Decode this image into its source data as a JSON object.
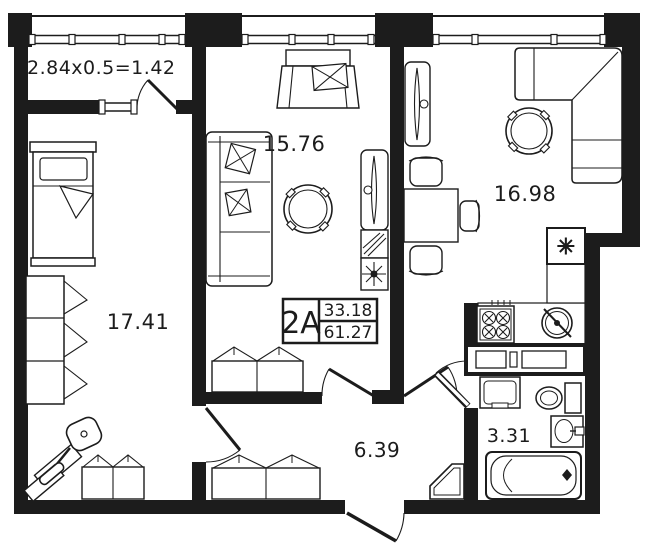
{
  "plan": {
    "unit_title": "2A",
    "living_area": "33.18",
    "total_area": "61.27",
    "balcony_formula": "2.84x0.5=1.42",
    "rooms": {
      "bedroom": "17.41",
      "living_room": "15.76",
      "kitchen_living": "16.98",
      "hallway": "6.39",
      "bathroom": "3.31"
    },
    "symbols": {
      "fridge": "✳"
    },
    "colors": {
      "walls": "#1c1c1c",
      "background": "#ffffff"
    }
  }
}
